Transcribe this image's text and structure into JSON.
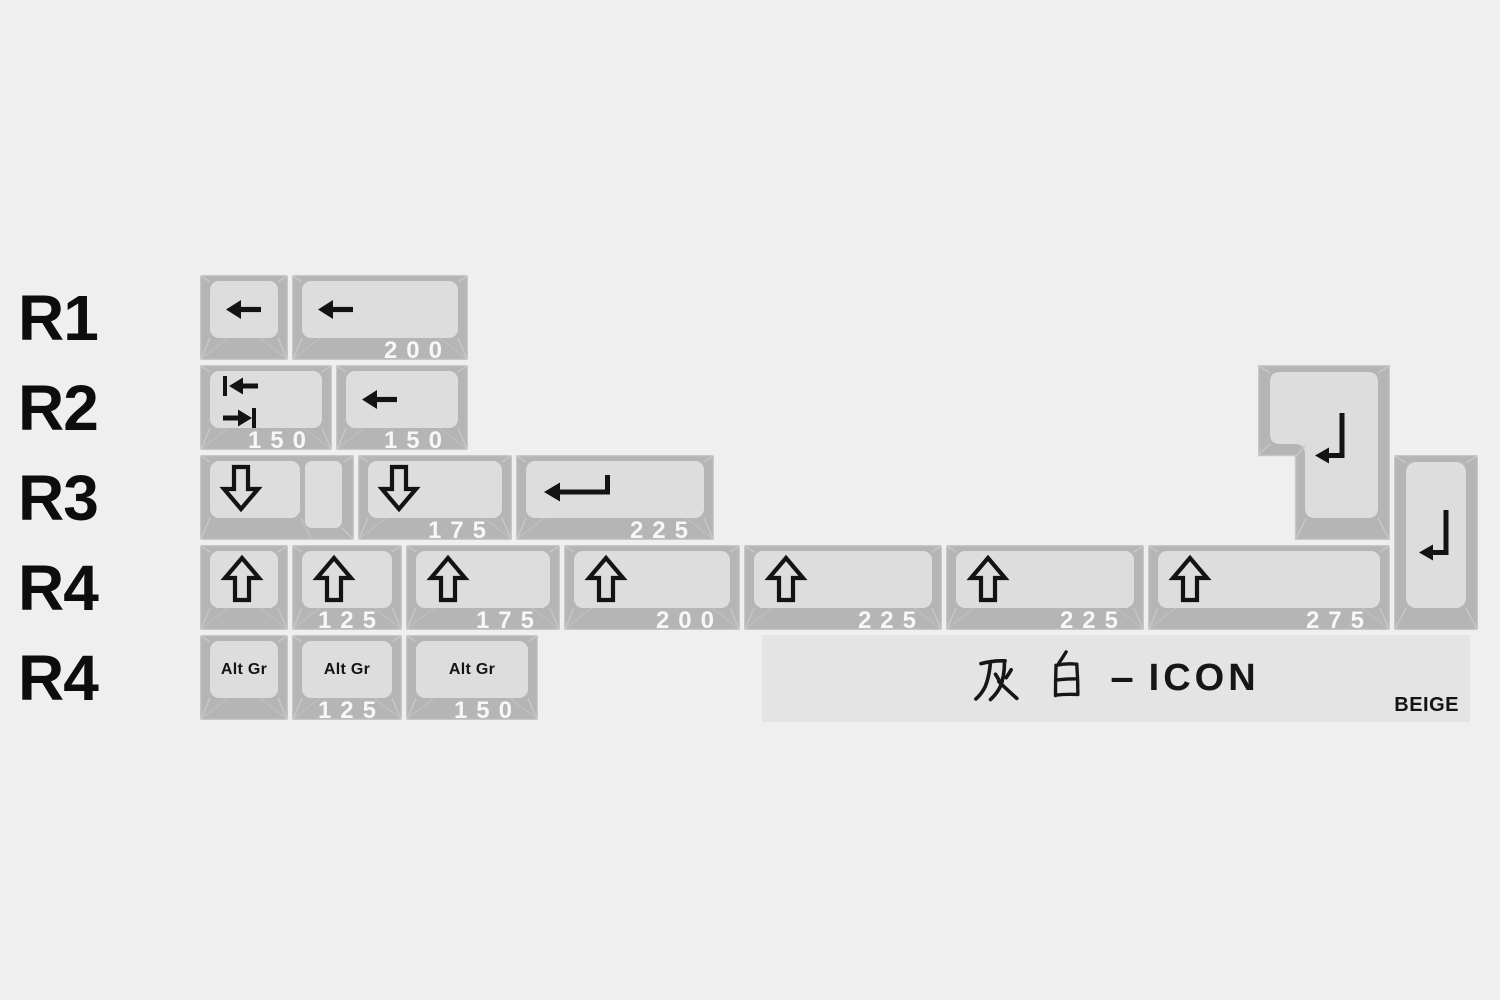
{
  "colors": {
    "background": "#efefef",
    "key_frame": "#b5b5b5",
    "key_frame_edge": "#c7c7c7",
    "key_surface": "#dddddd",
    "bevel_line": "#c9c9c9",
    "glyph": "#131313",
    "size_label_text": "#f7f7f7",
    "row_label_text": "#0d0d0d",
    "banner_bg": "#e4e4e4",
    "banner_text": "#161616"
  },
  "layout": {
    "unit_px": 88,
    "gap_px": 4,
    "key_height_px": 85,
    "row_pitch_px": 90,
    "origin_x": 200,
    "origin_y": 275
  },
  "rows": [
    {
      "label": "R1",
      "keys": [
        {
          "glyph": "arrow-left",
          "units": 1,
          "size_label": ""
        },
        {
          "glyph": "arrow-left",
          "units": 2,
          "size_label": "200"
        }
      ]
    },
    {
      "label": "R2",
      "keys": [
        {
          "glyph": "tab-arrows",
          "units": 1.5,
          "size_label": "150"
        },
        {
          "glyph": "arrow-left",
          "units": 1.5,
          "size_label": "150"
        }
      ]
    },
    {
      "label": "R3",
      "keys": [
        {
          "glyph": "down-arrow",
          "units": 1.75,
          "size_label": "",
          "type": "stepped"
        },
        {
          "glyph": "down-arrow",
          "units": 1.75,
          "size_label": "175"
        },
        {
          "glyph": "enter-arrow-wide",
          "units": 2.25,
          "size_label": "225"
        }
      ]
    },
    {
      "label": "R4",
      "keys": [
        {
          "glyph": "up-arrow",
          "units": 1,
          "size_label": ""
        },
        {
          "glyph": "up-arrow",
          "units": 1.25,
          "size_label": "125"
        },
        {
          "glyph": "up-arrow",
          "units": 1.75,
          "size_label": "175"
        },
        {
          "glyph": "up-arrow",
          "units": 2,
          "size_label": "200"
        },
        {
          "glyph": "up-arrow",
          "units": 2.25,
          "size_label": "225"
        },
        {
          "glyph": "up-arrow",
          "units": 2.25,
          "size_label": "225"
        },
        {
          "glyph": "up-arrow",
          "units": 2.75,
          "size_label": "275"
        }
      ]
    },
    {
      "label": "R4",
      "keys": [
        {
          "legend": "Alt Gr",
          "units": 1,
          "size_label": ""
        },
        {
          "legend": "Alt Gr",
          "units": 1.25,
          "size_label": "125"
        },
        {
          "legend": "Alt Gr",
          "units": 1.5,
          "size_label": "150"
        }
      ]
    }
  ],
  "special_keys": [
    {
      "name": "iso-enter",
      "glyph": "enter-arrow-tall",
      "x": 1258,
      "y": 365,
      "w": 132,
      "h": 175,
      "size_label": ""
    },
    {
      "name": "vertical-enter-2u",
      "glyph": "enter-arrow-tall",
      "x": 1394,
      "y": 455,
      "w": 84,
      "h": 175,
      "size_label": ""
    }
  ],
  "banner": {
    "cjk_name": "灰白",
    "separator": "–",
    "latin_name": "ICON",
    "corner_label": "BEIGE",
    "x": 762,
    "y": 635,
    "w": 708,
    "h": 87
  }
}
